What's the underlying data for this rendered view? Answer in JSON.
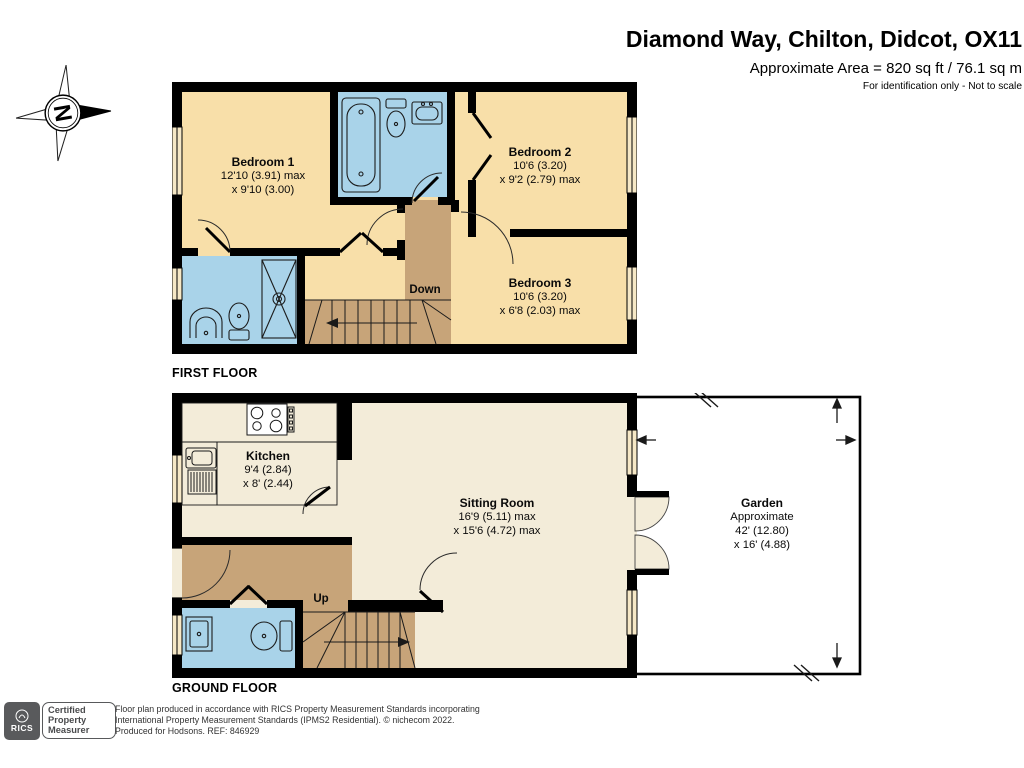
{
  "header": {
    "title": "Diamond Way, Chilton, Didcot, OX11",
    "area": "Approximate Area = 820 sq ft / 76.1 sq m",
    "note": "For identification only - Not to scale"
  },
  "compass": {
    "north": "N"
  },
  "first_floor": {
    "label": "FIRST FLOOR",
    "stairs": "Down",
    "rooms": {
      "bedroom1": {
        "name": "Bedroom 1",
        "dims": [
          "12'10 (3.91) max",
          "x 9'10 (3.00)"
        ]
      },
      "bedroom2": {
        "name": "Bedroom 2",
        "dims": [
          "10'6 (3.20)",
          "x 9'2 (2.79) max"
        ]
      },
      "bedroom3": {
        "name": "Bedroom 3",
        "dims": [
          "10'6 (3.20)",
          "x 6'8 (2.03) max"
        ]
      }
    }
  },
  "ground_floor": {
    "label": "GROUND FLOOR",
    "stairs": "Up",
    "rooms": {
      "kitchen": {
        "name": "Kitchen",
        "dims": [
          "9'4 (2.84)",
          "x 8' (2.44)"
        ]
      },
      "sitting_room": {
        "name": "Sitting Room",
        "dims": [
          "16'9 (5.11) max",
          "x 15'6 (4.72) max"
        ]
      },
      "garden": {
        "name": "Garden",
        "dims": [
          "Approximate",
          "42' (12.80)",
          "x 16' (4.88)"
        ]
      }
    }
  },
  "footer": {
    "logo_text": "RICS",
    "badge": [
      "Certified",
      "Property",
      "Measurer"
    ],
    "lines": [
      "Floor plan produced in accordance with RICS Property Measurement Standards incorporating",
      "International Property Measurement Standards (IPMS2 Residential).   © nichecom 2022.",
      "Produced for Hodsons.   REF: 846929"
    ]
  },
  "colors": {
    "wall": "#000000",
    "bedroom": "#f8dfa9",
    "bathroom": "#a9d3e9",
    "landing": "#c7a479",
    "living": "#f3ecd9",
    "window": "#f6e8c6",
    "garden": "#ffffff"
  }
}
